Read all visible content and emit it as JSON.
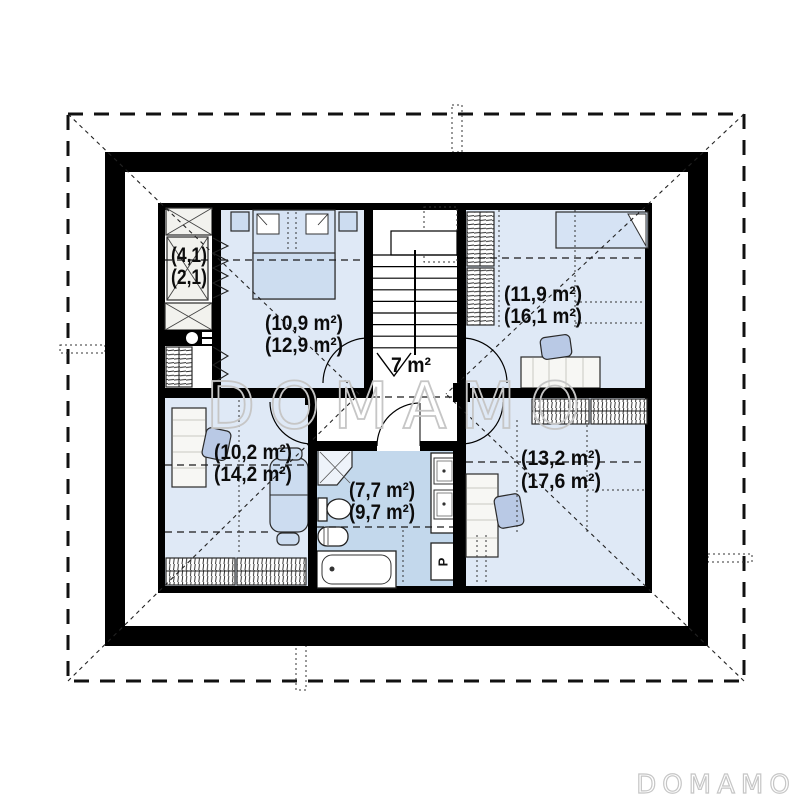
{
  "watermark": {
    "center": "DOMAMO",
    "corner": "DOMAMO"
  },
  "rooms": {
    "closet": {
      "name": "closet",
      "area_line1": "(4,1)",
      "area_line2": "(2,1)"
    },
    "bedroom_tl": {
      "name": "bedroom top left",
      "area_line1": "(10,9 m²)",
      "area_line2": "(12,9 m²)"
    },
    "hall": {
      "name": "hall with stairs",
      "area_line1": "7 m²"
    },
    "bedroom_tr": {
      "name": "bedroom top right",
      "area_line1": "(11,9 m²)",
      "area_line2": "(16,1 m²)"
    },
    "room_bl": {
      "name": "room bottom left",
      "area_line1": "(10,2 m²)",
      "area_line2": "(14,2 m²)"
    },
    "bathroom": {
      "name": "bathroom",
      "area_line1": "(7,7 m²)",
      "area_line2": "(9,7 m²)"
    },
    "room_br": {
      "name": "room bottom right",
      "area_line1": "(13,2 m²)",
      "area_line2": "(17,6 m²)"
    }
  },
  "appliances": {
    "washer_label": "P"
  },
  "colors": {
    "wall": "#000000",
    "floor": "#dfe9f6",
    "bathroom": "#c3d8ec",
    "hall": "#ffffff",
    "bed": "#d6e3f4",
    "blanket": "#cdddf0",
    "furniture": "#ccdcf0",
    "chair": "#b9c9e5",
    "watermark": "#c6c6c6"
  }
}
